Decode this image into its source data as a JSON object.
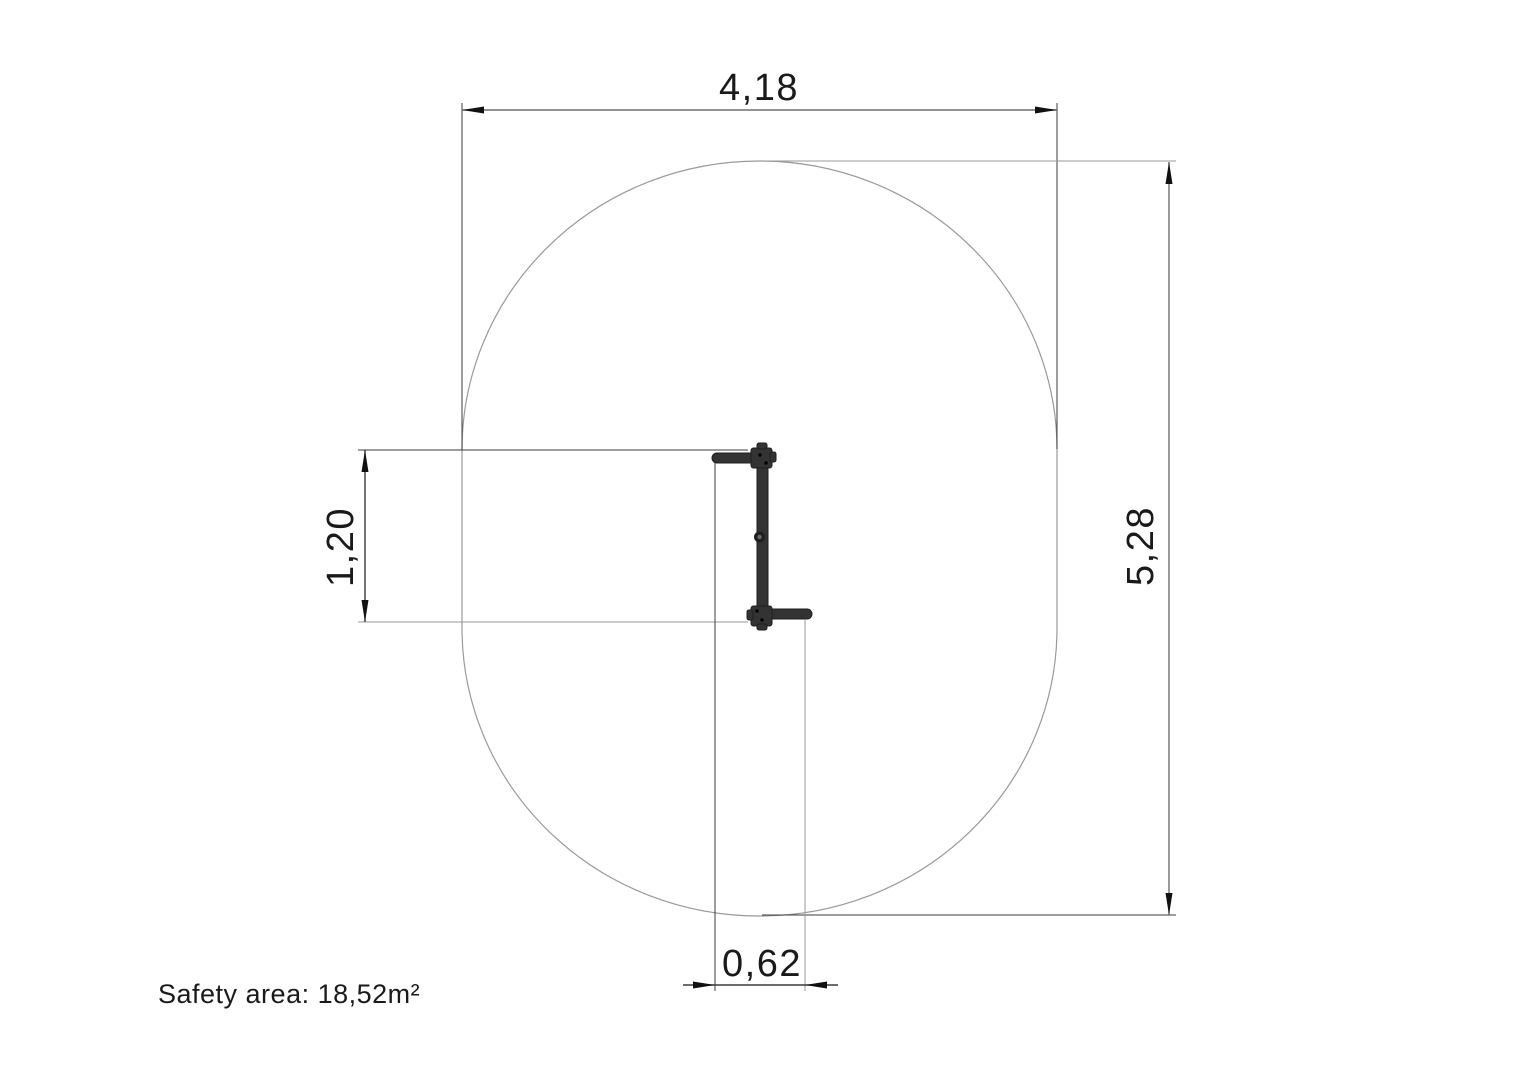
{
  "drawing": {
    "safety_note": "Safety area: 18,52m²",
    "dimensions": {
      "overall_width": "4,18",
      "overall_height": "5,28",
      "equipment_length": "1,20",
      "equipment_width": "0,62"
    },
    "colors": {
      "background": "#ffffff",
      "outline": "#9a9a9a",
      "dimension_line": "#6f6f6f",
      "extension_line": "#3c3c3c",
      "arrow": "#111111",
      "text": "#1a1a1a",
      "equipment": "#333333",
      "equipment_dark": "#1f1f1f"
    }
  }
}
